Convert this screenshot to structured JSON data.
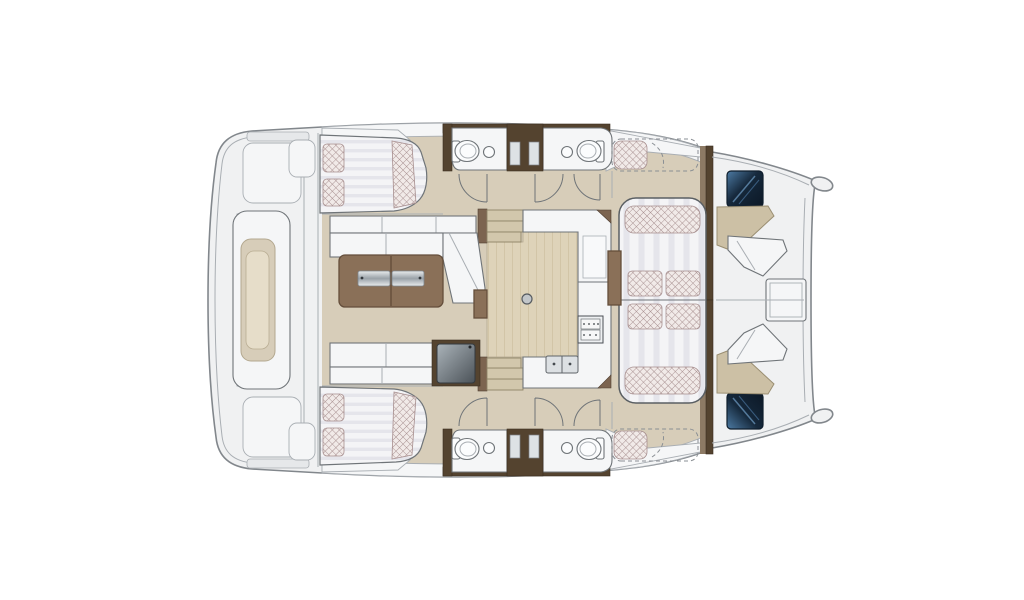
{
  "diagram": {
    "type": "catamaran-yacht-floorplan-top-view",
    "orientation": {
      "bow": "right",
      "stern": "left"
    },
    "features": [
      "stern-platform-with-central-lounge-pod",
      "aft-double-berth-cabin-port",
      "aft-double-berth-cabin-starboard",
      "twin-wc-compartments-port",
      "twin-wc-compartments-starboard",
      "salon-sofa-with-chaise",
      "wooden-coffee-table",
      "galley-with-stove-double-sink-fridge",
      "companionway-stairs-port",
      "companionway-stairs-starboard",
      "convertible-dinette-lounge",
      "forward-cockpit-with-benches-and-table",
      "bow-deck-hatches",
      "twin-hull-bow-tips"
    ],
    "counts": {
      "double_berths": 2,
      "pillows_per_berth": 2,
      "toilets": 4,
      "bathroom_sinks": 4,
      "galley_sink_bowls": 2,
      "stove_panels": 2,
      "companionway_stairs": 2,
      "stair_steps_each": 3,
      "lounge_cushions": 4,
      "lounge_bolsters": 2,
      "bow_hatches": 2,
      "door_swings_per_hull": 3,
      "coffee_table_metal_inserts": 2
    }
  },
  "colors": {
    "page_bg": "#ffffff",
    "hull_fill": "#f0f1f2",
    "hull_line": "#82878c",
    "soft_line": "#a9aeb3",
    "furn_line": "#6f7478",
    "white_furn": "#f5f6f7",
    "deck": "#d7cdb9",
    "deck_line": "#b3a88f",
    "wood_floor": "#ded3b9",
    "wood_grain": "#cfc2a3",
    "brown_dark": "#54432f",
    "brown_mid": "#7c6450",
    "table_wood": "#8a7058",
    "table_wood_dark": "#644e3b",
    "cushion_bg": "#f1eae8",
    "cushion_line": "#a78f8f",
    "stripe_a": "#f4f4f6",
    "stripe_b": "#e5e5eb",
    "bench_beige": "#ccc0a5",
    "stair_fill": "#d2c7ac",
    "hatch_navy": "#16293c",
    "hatch_blue": "#4d7ba4",
    "steel_light": "#e9eced",
    "steel_dark": "#99a1a8",
    "fridge_dark": "#4b5258",
    "fridge_light": "#aab3b9"
  }
}
